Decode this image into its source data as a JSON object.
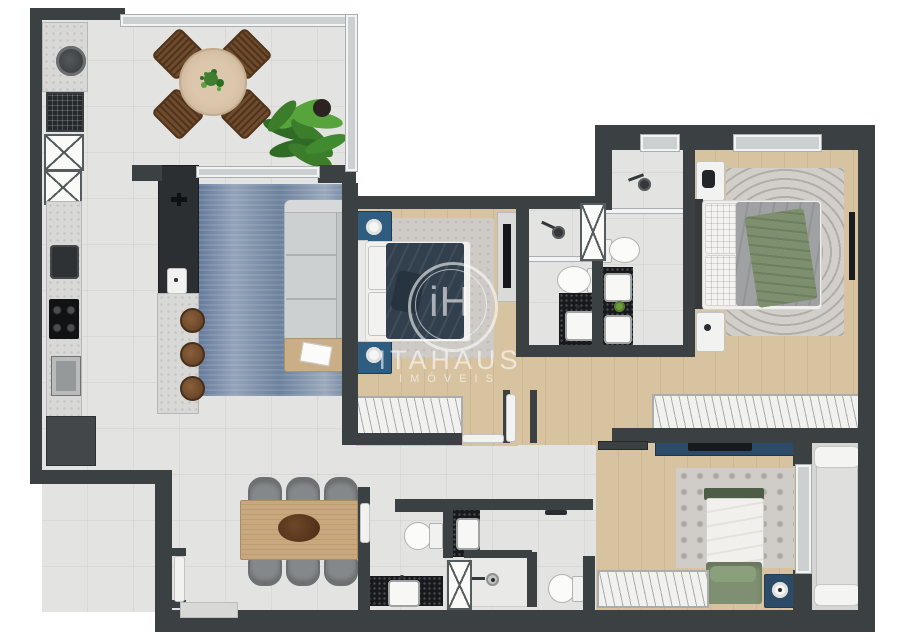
{
  "watermark": {
    "monogram": "iH",
    "brand": "ITAHAUS",
    "subtitle": "IMÓVEIS"
  },
  "colors": {
    "wall": "#3b4043",
    "tile": "#e3e3e1",
    "wood": "#d8c3a1",
    "wood_table": "#c9a87e",
    "marble": "#d8d9d7",
    "granite": "#17191c",
    "sofa": "#cdd0d1",
    "rug_blue": "#64799a",
    "rug_gray": "#cfccc7",
    "navy_duvet": "#32404e",
    "master_duvet": "#9fa1a2",
    "green_throw": "#7e8f6e",
    "green_bed": "#7e9071",
    "blue_furniture": "#2f5d80",
    "stool_brown": "#6f4a2b",
    "chair_gray": "#85888a",
    "balcony": "#d5d6d4",
    "glass": "#ccd0d1",
    "plant_green": "#3f7d2f",
    "watermark": "rgba(255,255,255,0.58)"
  }
}
